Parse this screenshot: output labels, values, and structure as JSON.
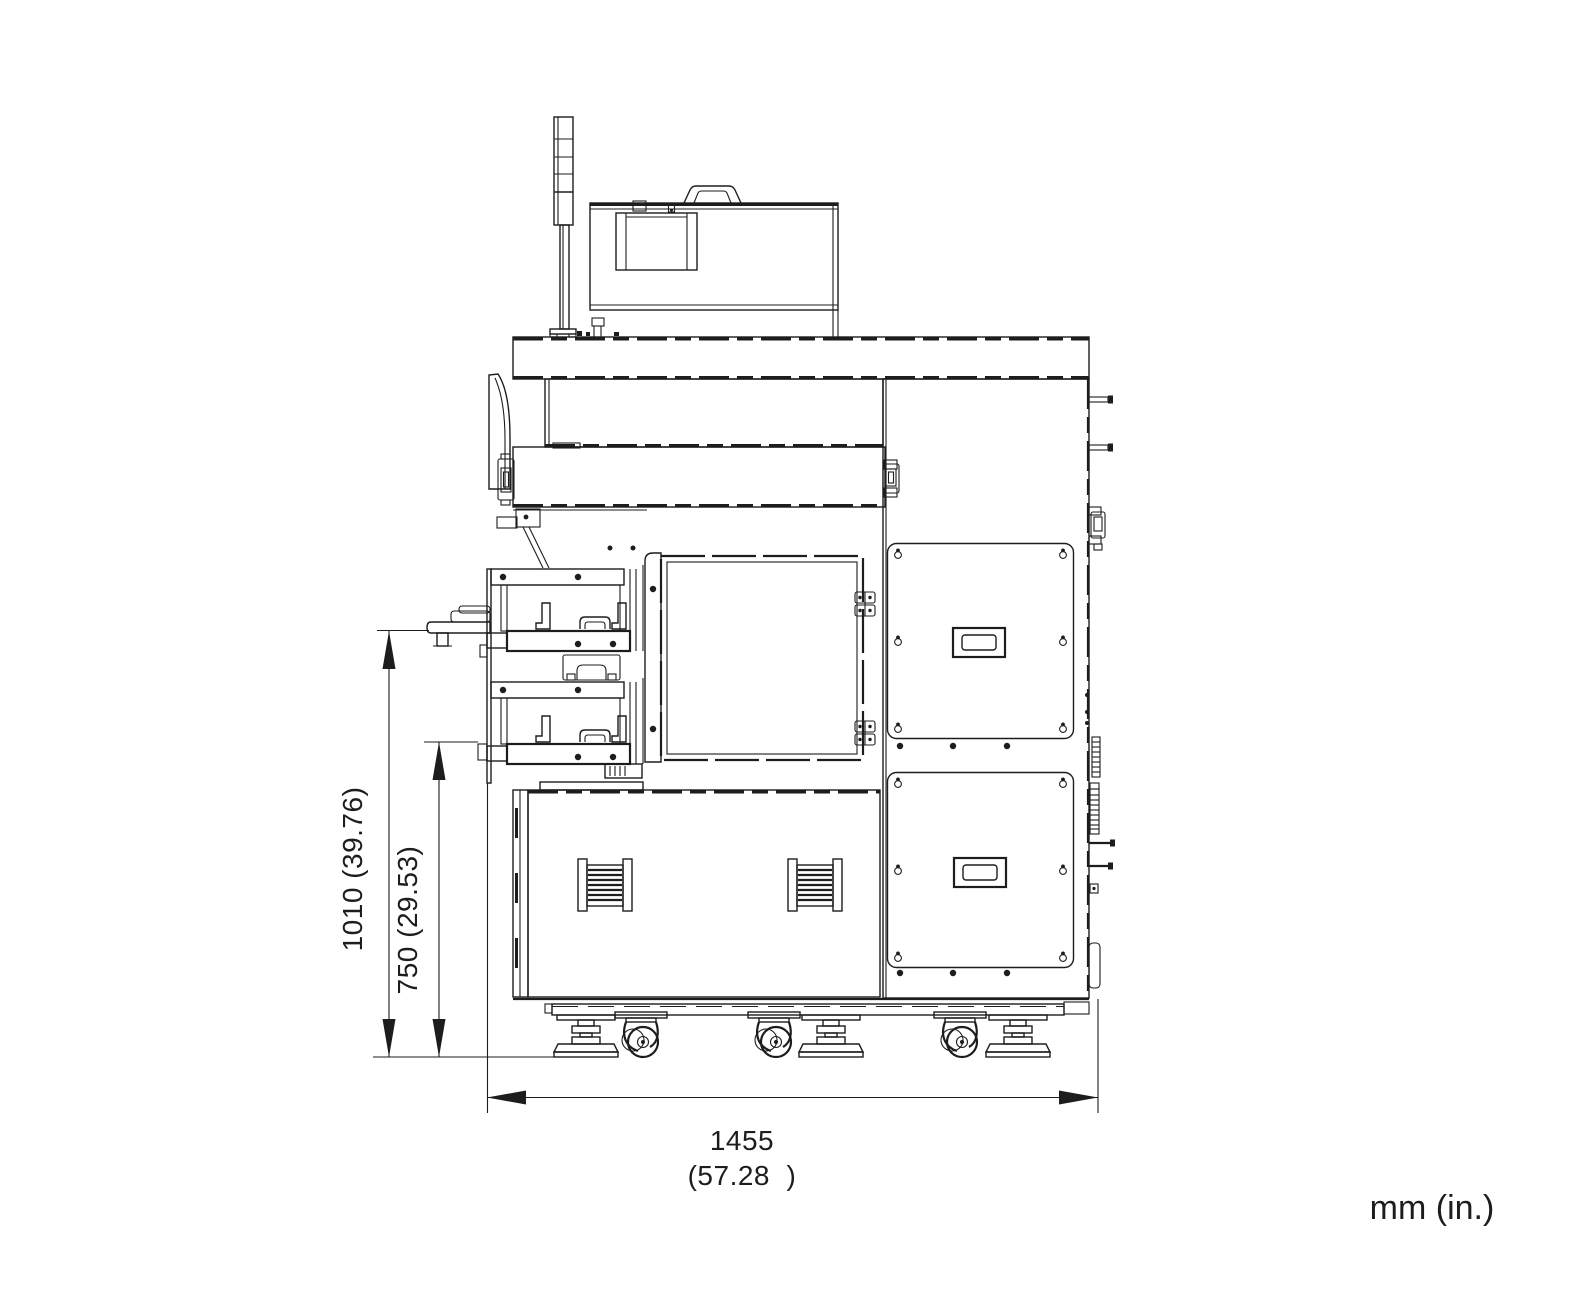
{
  "colors": {
    "line": "#1d1d1b",
    "background": "#ffffff"
  },
  "dimensions": {
    "overall_height": {
      "label": "1010 (39.76)",
      "mm": "1010",
      "inches": "39.76"
    },
    "table_height": {
      "label": "750 (29.53)",
      "mm": "750",
      "inches": "29.53"
    },
    "overall_width": {
      "label_mm": "1455",
      "label_in": "(57.28  )",
      "mm": "1455",
      "inches": "57.28"
    }
  },
  "units": {
    "label": "mm (in.)"
  }
}
